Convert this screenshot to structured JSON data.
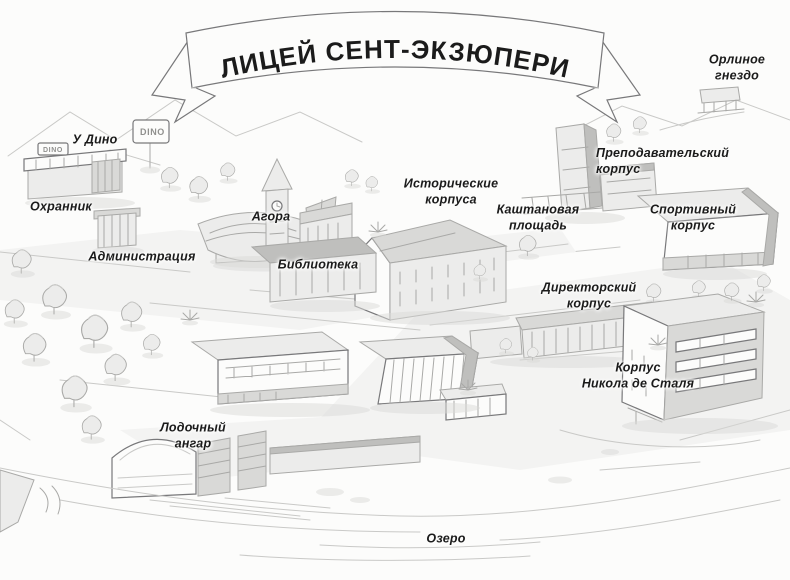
{
  "banner": {
    "title": "ЛИЦЕЙ СЕНТ-ЭКЗЮПЕРИ"
  },
  "labels": {
    "eagles_nest": "Орлиное\nгнездо",
    "dinos": "У Дино",
    "guard": "Охранник",
    "agora": "Агора",
    "administration": "Администрация",
    "library": "Библиотека",
    "historic_buildings": "Исторические\nкорпуса",
    "chestnut_square": "Каштановая\nплощадь",
    "teachers_building": "Преподавательский\nкорпус",
    "sports_building": "Спортивный\nкорпус",
    "directors_building": "Директорский\nкорпус",
    "stael_building": "Корпус\nНикола де Сталя",
    "boat_hangar": "Лодочный\nангар",
    "lake": "Озеро"
  },
  "signs": {
    "dino_pole_sign": "DINO",
    "dino_awning_sign": "DINO"
  },
  "colors": {
    "ink": "#1b1b1b",
    "edge": "#78787a",
    "line": "#a9a9a7",
    "paper": "#fcfcfb",
    "g1": "#ececeb",
    "g2": "#d9d9d7",
    "g3": "#bfbfbd"
  }
}
